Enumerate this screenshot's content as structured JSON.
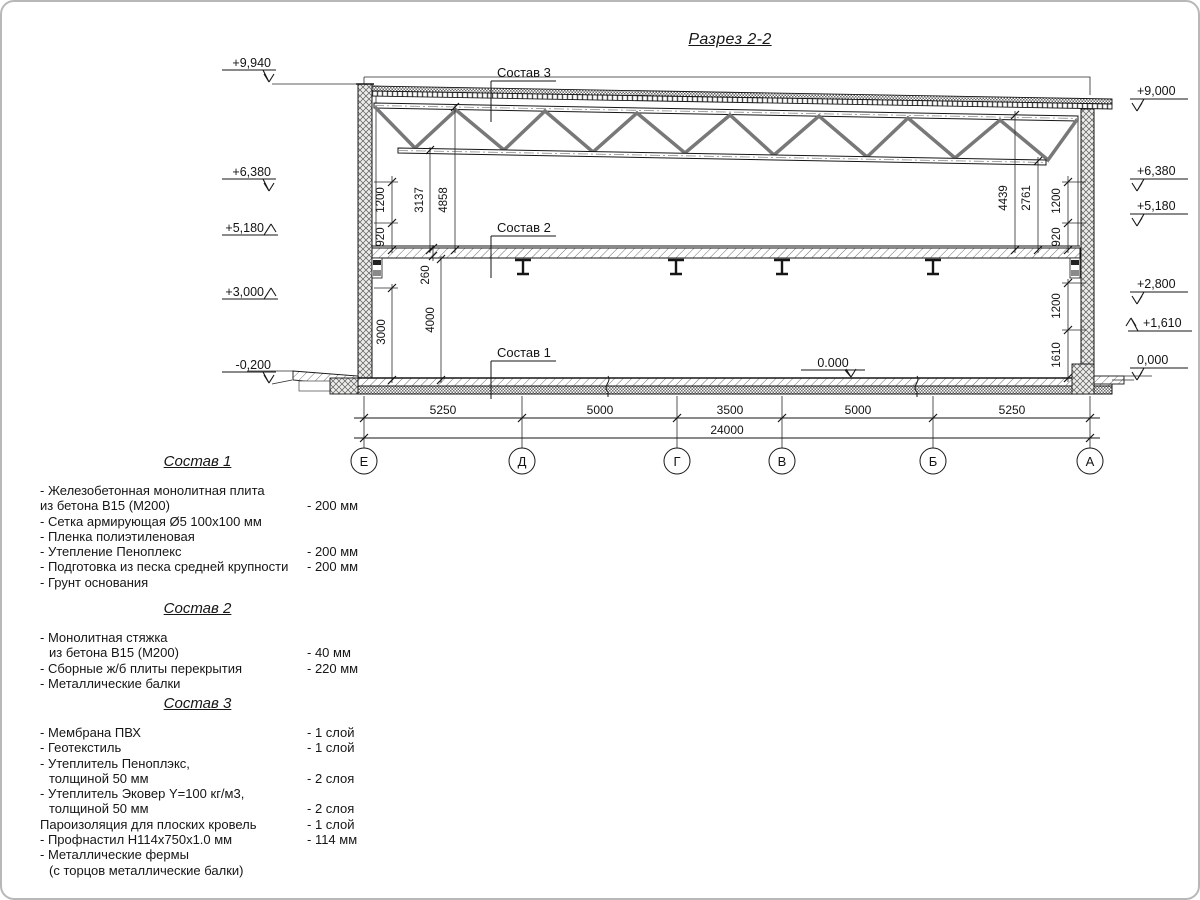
{
  "page": {
    "title": "Разрез 2-2"
  },
  "drawing": {
    "elev_left": [
      "+9,940",
      "+6,380",
      "+5,180",
      "+3,000",
      "-0,200"
    ],
    "elev_right": [
      "+9,000",
      "+6,380",
      "+5,180",
      "+2,800",
      "+1,610",
      "0,000"
    ],
    "floor_mark": "0.000",
    "leader_3": "Состав 3",
    "leader_2": "Состав 2",
    "leader_1": "Состав 1",
    "dims_left": [
      "1200",
      "920",
      "3000"
    ],
    "dims_inner_left": [
      "3137",
      "4858",
      "260",
      "4000"
    ],
    "dims_inner_right": [
      "4439",
      "2761"
    ],
    "dims_right_upper": [
      "1200",
      "920"
    ],
    "dims_right_lower": [
      "1200",
      "1610"
    ],
    "dims_spans": [
      "5250",
      "5000",
      "3500",
      "5000",
      "5250"
    ],
    "dim_total": "24000",
    "axes": [
      "Е",
      "Д",
      "Г",
      "В",
      "Б",
      "А"
    ]
  },
  "specs": [
    {
      "heading": "Состав 1",
      "rows": [
        {
          "text": "- Железобетонная  монолитная плита"
        },
        {
          "text": "из бетона  В15 (М200)",
          "value": "- 200 мм"
        },
        {
          "text": "- Сетка армирующая Ø5 100х100 мм"
        },
        {
          "text": "- Пленка полиэтиленовая"
        },
        {
          "text": "- Утепление Пеноплекс",
          "value": "- 200 мм"
        },
        {
          "text": "- Подготовка из песка средней  крупности",
          "value": "- 200 мм"
        },
        {
          "text": "- Грунт основания"
        }
      ]
    },
    {
      "heading": "Состав 2",
      "rows": [
        {
          "text": "- Монолитная стяжка"
        },
        {
          "text": "из бетона В15 (М200)",
          "value": "- 40 мм"
        },
        {
          "text": "- Сборные ж/б плиты перекрытия",
          "value": "- 220 мм"
        },
        {
          "text": "- Металлические балки"
        }
      ]
    },
    {
      "heading": "Состав 3",
      "rows": [
        {
          "text": "- Мембрана ПВХ",
          "value": "- 1 слой"
        },
        {
          "text": "- Геотекстиль",
          "value": "- 1 слой"
        },
        {
          "text": "- Утеплитель Пеноплэкс,"
        },
        {
          "text": "толщиной 50 мм",
          "value": "- 2 слоя"
        },
        {
          "text": "- Утеплитель Эковер Y=100 кг/м3,"
        },
        {
          "text": "толщиной 50 мм",
          "value": "- 2 слоя"
        },
        {
          "text": "Пароизоляция для плоских кровель",
          "value": "- 1 слой"
        },
        {
          "text": "- Профнастил Н114х750х1.0 мм",
          "value": "- 114 мм"
        },
        {
          "text": "- Металлические фермы"
        },
        {
          "text": "(с торцов металлические балки)"
        }
      ]
    }
  ]
}
